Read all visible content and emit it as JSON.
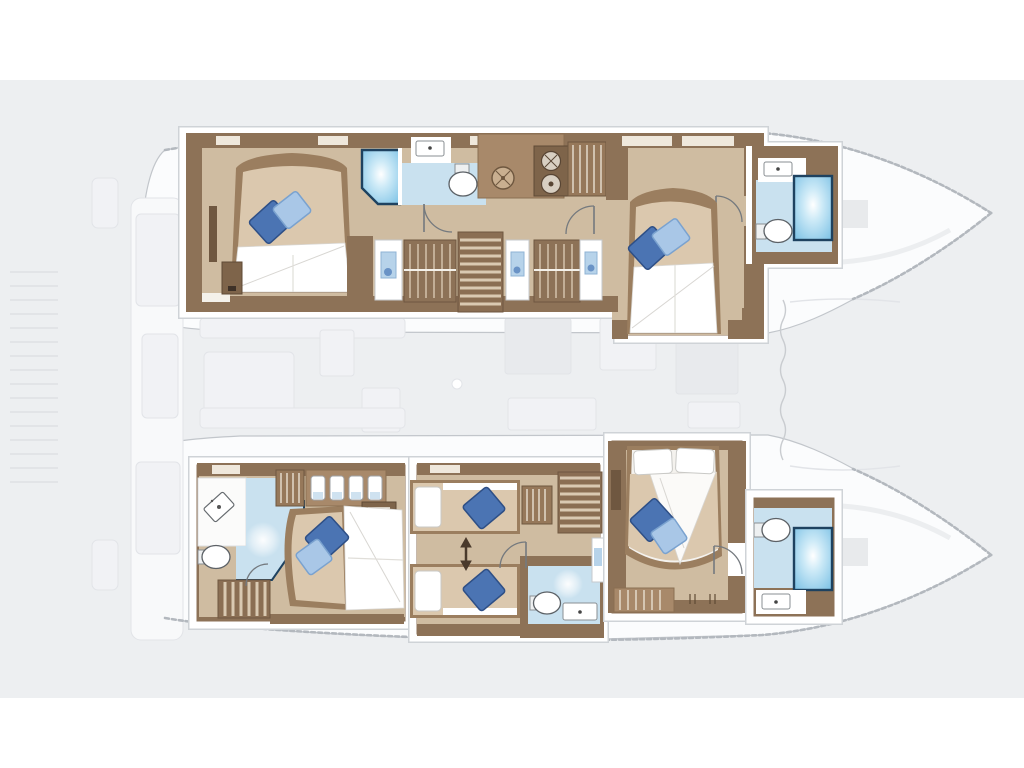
{
  "description": "Catamaran yacht lower-deck layout plan: four double cabins with blue accent pillows, five heads with showers, twin single berths, companionway stairs in each hull; central salon, aft cockpit, swim platform and bow lockers shown faded grey.",
  "colors": {
    "page_bg": "#ffffff",
    "canvas_bg": "#edeff1",
    "hull_fill": "#fbfcfd",
    "hull_stroke": "#c2c6cb",
    "rope_stroke": "#b3b8be",
    "faded_fill": "#f1f2f5",
    "faded_fill_dark": "#e8eaed",
    "faded_stroke": "#e2e4e8",
    "frame_white": "#ffffff",
    "frame_edge": "#cfd3d7",
    "wood_dark": "#8d7257",
    "wood_deep": "#7e644a",
    "wood_mid": "#a8896a",
    "wood_knob": "#3e3127",
    "wood_panel": "#efe8dc",
    "floor_tan": "#cfbca1",
    "bed_frame": "#9b7e5f",
    "bed_tan": "#dbc8ae",
    "linen": "#ffffff",
    "linen_line": "#d8d6d2",
    "pillow_dark": "#4b74b3",
    "pillow_dark_edge": "#2e4f86",
    "pillow_light": "#a9c7e7",
    "pillow_light_edge": "#7aa2cf",
    "bath_floor": "#c9e1ef",
    "shower_blue": "#7fc3e6",
    "shower_border": "#1e4260",
    "fixture_stroke": "#5c6166",
    "stair_base": "#8a6e53",
    "stair_stripe": "#d9c9b2",
    "door_pic": "#b7d3ea",
    "door_pic_edge": "#8fb3d4",
    "door_pic_blob": "#6a93c6",
    "door_arc": "#74797e",
    "arrow": "#4a3a2c"
  },
  "rooms": [
    {
      "name": "port-aft-cabin",
      "features": [
        "double-bed",
        "pillow-dark",
        "pillow-light",
        "bedside-unit"
      ]
    },
    {
      "name": "port-aft-head",
      "features": [
        "shower",
        "sink",
        "toilet"
      ]
    },
    {
      "name": "port-companionway",
      "features": [
        "stairs",
        "galley-hob",
        "appliances",
        "lockers",
        "doors"
      ]
    },
    {
      "name": "port-forward-cabin",
      "features": [
        "double-bed",
        "pillow-dark",
        "pillow-light",
        "wardrobe"
      ]
    },
    {
      "name": "port-forward-head",
      "features": [
        "shower",
        "sink",
        "toilet"
      ]
    },
    {
      "name": "starboard-aft-cabin",
      "features": [
        "double-bed",
        "pillow-dark",
        "pillow-light",
        "vanity-sink",
        "toilet",
        "shower-floor",
        "stairs",
        "locker-jars"
      ]
    },
    {
      "name": "starboard-mid-berths",
      "features": [
        "single-berth",
        "single-berth",
        "pillow-dark",
        "stairs",
        "toilet",
        "sink",
        "shower-floor",
        "passage-arrow"
      ]
    },
    {
      "name": "starboard-forward-cabin",
      "features": [
        "double-bed",
        "white-pillows",
        "pillow-dark",
        "pillow-light",
        "lockers"
      ]
    },
    {
      "name": "starboard-forward-head",
      "features": [
        "shower",
        "sink",
        "toilet"
      ]
    },
    {
      "name": "salon-deck",
      "state": "faded"
    },
    {
      "name": "aft-cockpit",
      "state": "faded"
    },
    {
      "name": "swim-platform",
      "state": "faded"
    },
    {
      "name": "bow-lockers",
      "state": "faded"
    }
  ]
}
